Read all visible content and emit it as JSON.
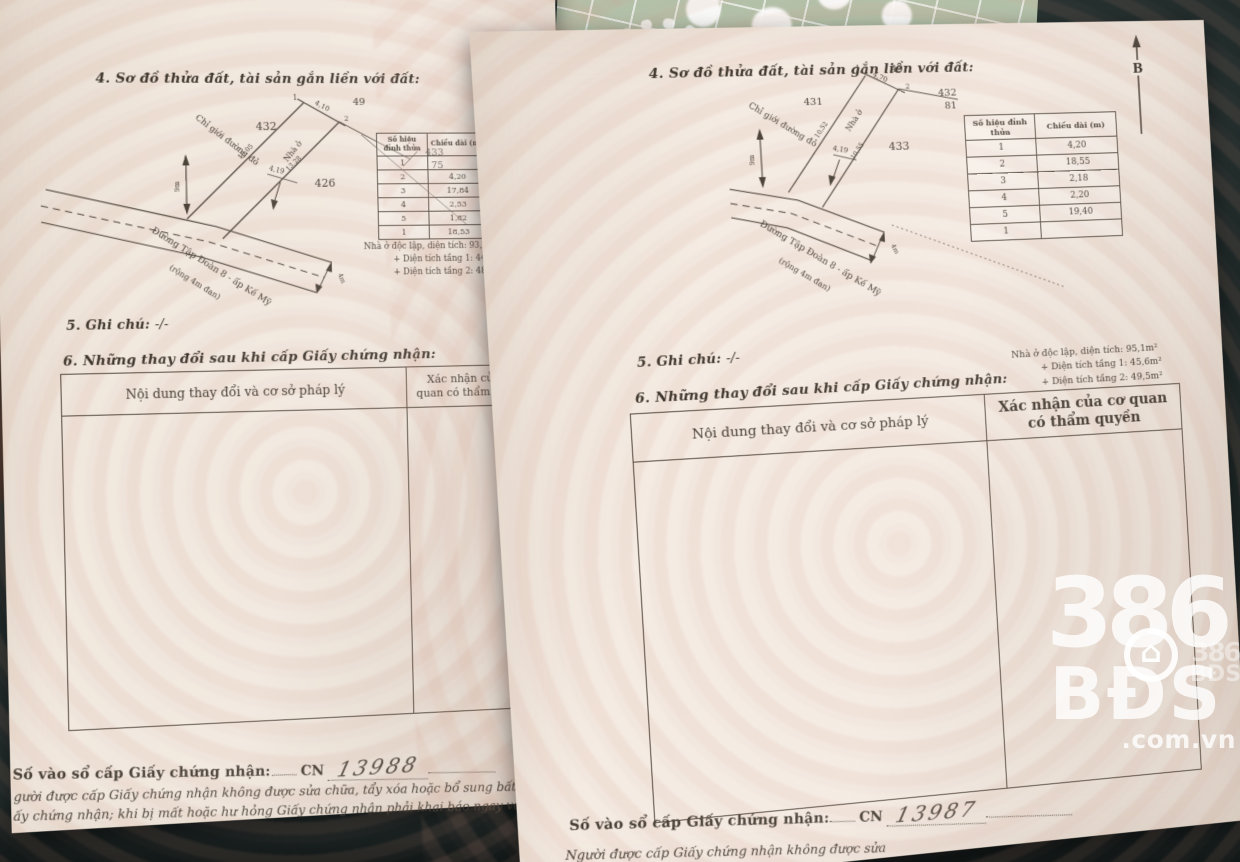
{
  "watermark": {
    "number": "386",
    "brand": "BĐS",
    "suffix": ".com.vn",
    "house_icon": "⌂",
    "mini_number": "386",
    "mini_brand": "BĐS"
  },
  "pages": [
    {
      "section4_title": "4. Sơ đồ thửa đất, tài sản gắn liền với đất:",
      "north_label": "B",
      "diagram": {
        "left_parcel": "432",
        "top_parcel": "49",
        "corner_parcel": "433",
        "corner_sub": "75",
        "lower_parcel": "426",
        "vertex_1": "1",
        "vertex_2": "2",
        "house_label": "Nhà ở",
        "red_boundary_label": "Chỉ giới đường đỏ",
        "road_name": "Đường Tập Đoàn 8 - ấp Kế Mỹ",
        "road_note": "(rộng 4m đan)",
        "dim_top": "4,10",
        "dim_left": "10,05",
        "dim_right": "13,28",
        "dim_mid": "4,19",
        "dim_depth": "9m",
        "dim_road": "4m"
      },
      "edge_table": {
        "col1_header": "Số hiệu đỉnh thửa",
        "col2_header": "Chiều dài (m)",
        "rows": [
          {
            "v": "1",
            "len": ""
          },
          {
            "v": "2",
            "len": "4,20"
          },
          {
            "v": "3",
            "len": "17,84"
          },
          {
            "v": "4",
            "len": "2,53"
          },
          {
            "v": "5",
            "len": "1,82"
          },
          {
            "v": "1",
            "len": "18,53"
          }
        ]
      },
      "house_notes": {
        "line1": "Nhà ở độc lập, diện tích: 93,2m²",
        "line2": "+ Diện tích tầng 1: 44,7m²",
        "line3": "+ Diện tích tầng 2: 48,5m²"
      },
      "section5_label": "5. Ghi chú:",
      "section5_value": "-/-",
      "section6_title": "6. Những thay đổi sau khi cấp Giấy chứng nhận:",
      "change_table": {
        "col1_header": "Nội dung thay đổi và cơ sở pháp lý",
        "col2_header": "Xác nhận của cơ quan có thẩm quyền"
      },
      "registry": {
        "label": "Số vào sổ cấp Giấy chứng nhận:",
        "prefix": "CN",
        "number": "13988"
      },
      "footer_line1": "gười được cấp Giấy chứng nhận không được sửa chữa, tẩy xóa hoặc bổ sung bất kỳ nội dung nào tron",
      "footer_line2": "ấy chứng nhận; khi bị mất hoặc hư hỏng Giấy chứng nhận phải khai báo ngay với cơ quan cấp Giấy,"
    },
    {
      "section4_title": "4. Sơ đồ thửa đất, tài sản gắn liền với đất:",
      "north_label": "B",
      "diagram": {
        "left_parcel": "431",
        "top_parcel": "49",
        "corner_parcel": "432",
        "corner_sub": "81",
        "lower_parcel": "433",
        "vertex_1": "1",
        "vertex_2": "2",
        "house_label": "Nhà ở",
        "red_boundary_label": "Chỉ giới đường đỏ",
        "road_name": "Đường Tập Đoàn 8 - ấp Kế Mỹ",
        "road_note": "(rộng 4m đan)",
        "dim_top": "4,70",
        "dim_left": "10,52",
        "dim_right": "10,55",
        "dim_mid": "4,19",
        "dim_depth": "9m",
        "dim_road": "4m"
      },
      "edge_table": {
        "col1_header": "Số hiệu đỉnh thửa",
        "col2_header": "Chiều dài (m)",
        "rows": [
          {
            "v": "1",
            "len": "4,20"
          },
          {
            "v": "2",
            "len": "18,55"
          },
          {
            "v": "3",
            "len": "2,18"
          },
          {
            "v": "4",
            "len": "2,20"
          },
          {
            "v": "5",
            "len": "19,40"
          },
          {
            "v": "1",
            "len": ""
          }
        ]
      },
      "house_notes": {
        "line1": "Nhà ở độc lập, diện tích: 95,1m²",
        "line2": "+ Diện tích tầng 1: 45,6m²",
        "line3": "+ Diện tích tầng 2: 49,5m²"
      },
      "section5_label": "5. Ghi chú:",
      "section5_value": "-/-",
      "section6_title": "6. Những thay đổi sau khi cấp Giấy chứng nhận:",
      "change_table": {
        "col1_header": "Nội dung thay đổi và cơ sở pháp lý",
        "col2_header": "Xác nhận của cơ quan có thẩm quyền"
      },
      "registry": {
        "label": "Số vào sổ cấp Giấy chứng nhận:",
        "prefix": "CN",
        "number": "13987"
      },
      "footer_line1": "Người được cấp Giấy chứng nhận không được sửa",
      "footer_line2": "Giấy chứng nhận; khi bị mất hoặc h"
    }
  ]
}
